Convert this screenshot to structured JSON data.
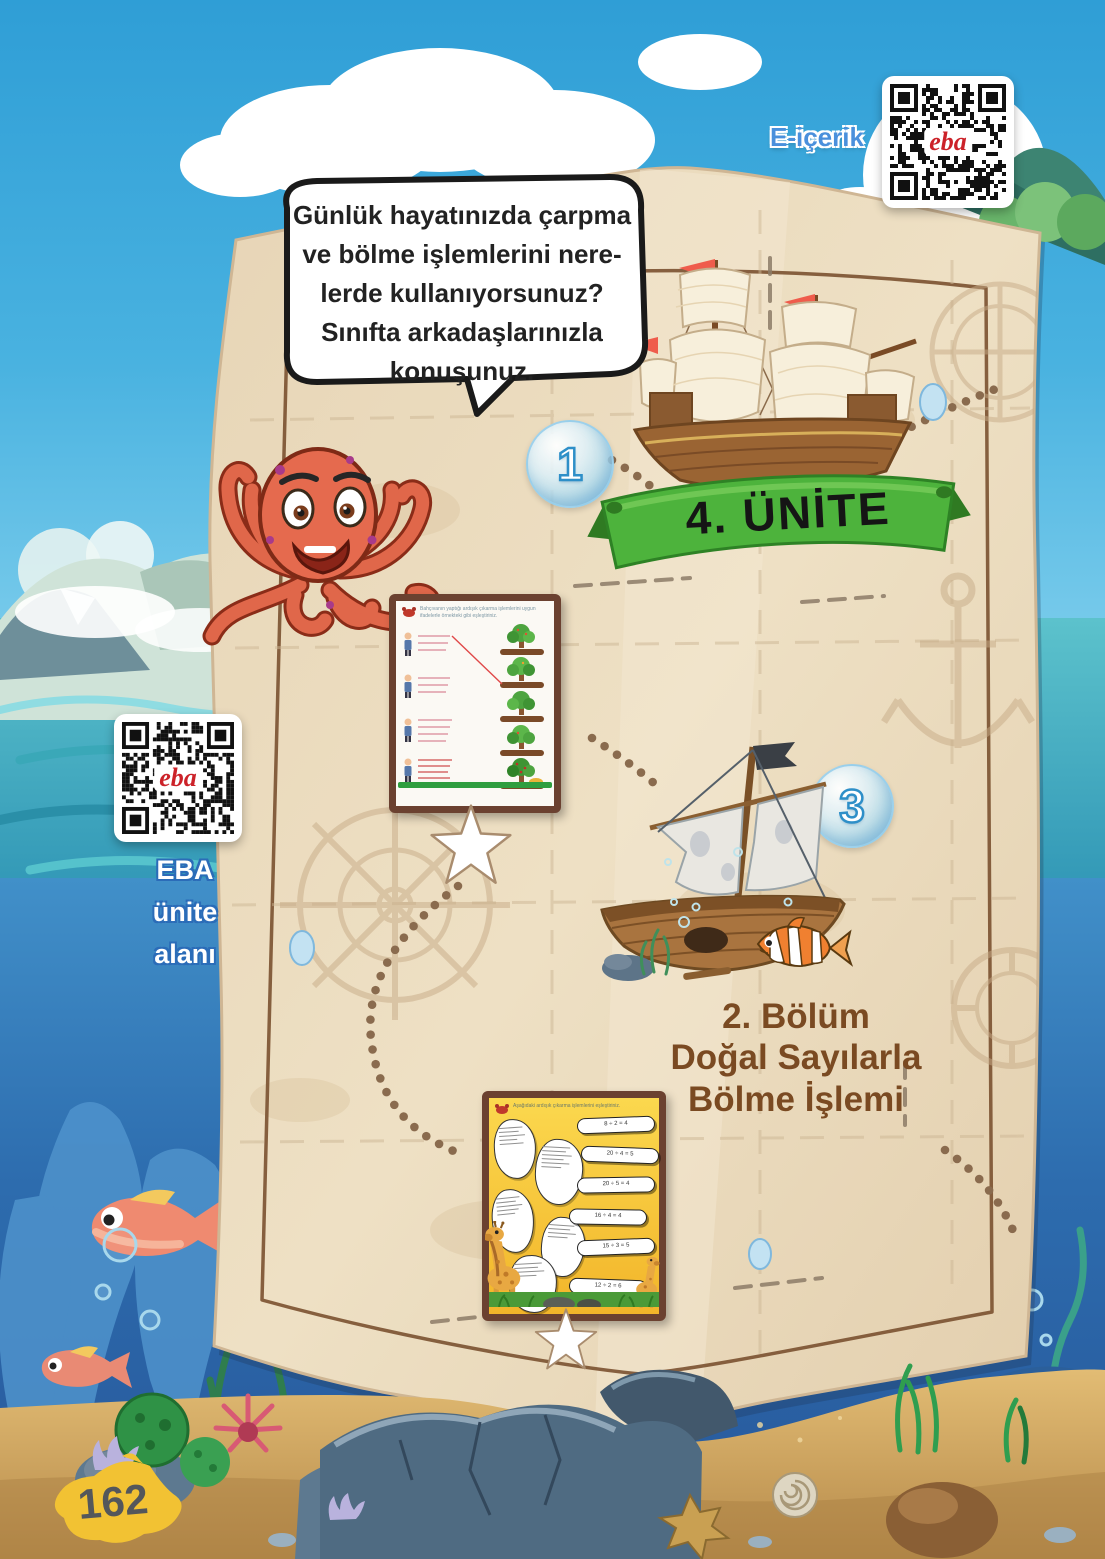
{
  "page": {
    "number": "162"
  },
  "qr_top": {
    "label": "E-içerik",
    "logo": "eba"
  },
  "qr_left": {
    "logo": "eba",
    "label_lines": [
      "EBA",
      "ünite",
      "alanı"
    ]
  },
  "speech": {
    "lines": [
      "Günlük hayatınızda çarpma",
      "ve bölme işlemlerini nere-",
      "lerde kullanıyorsunuz?",
      "Sınıfta arkadaşlarınızla",
      "konuşunuz."
    ]
  },
  "unit_banner": {
    "label": "4. ÜNİTE"
  },
  "markers": {
    "one": "1",
    "three": "3"
  },
  "section": {
    "line1": "2. Bölüm",
    "line2": "Doğal Sayılarla",
    "line3": "Bölme İşlemi"
  },
  "worksheet1": {
    "instruction": "Bahçıvanın yaptığı ardışık çıkarma işlemlerini uygun ifadelerle örnekteki gibi eşleştiriniz."
  },
  "worksheet2": {
    "instruction": "Aşağıdaki ardışık çıkarma işlemlerini eşleştiriniz.",
    "answers": [
      "8 ÷ 2 = 4",
      "20 ÷ 4 = 5",
      "20 ÷ 5 = 4",
      "16 ÷ 4 = 4",
      "15 ÷ 3 = 5",
      "12 ÷ 2 = 6"
    ]
  },
  "colors": {
    "sky": "#2f9ed6",
    "sea": "#4cbac6",
    "underwater": "#2d6cae",
    "parchment": "#eadbc0",
    "map_border": "#7a5130",
    "banner_green": "#4db33c",
    "accent_blue": "#4a90dc",
    "eba_red": "#cc2229",
    "title_brown": "#7a4a22",
    "ws2_yellow": "#f5c12e",
    "page_blob": "#f2c233"
  }
}
